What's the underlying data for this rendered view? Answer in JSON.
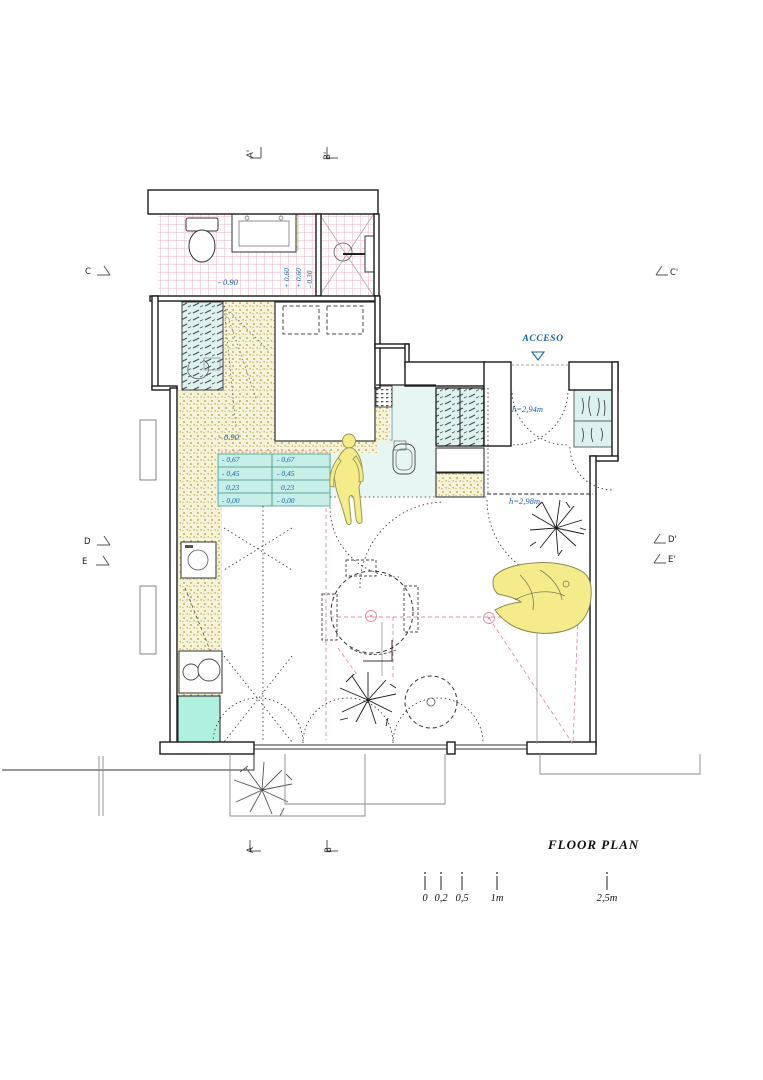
{
  "title": "FLOOR PLAN",
  "entry_label": "ACCESO",
  "heights": {
    "entry_hall": "h=2,94m",
    "living_room": "h=2,98m"
  },
  "bathroom": {
    "floor_level": "- 0.90",
    "shower_levels": [
      "+ 0.60",
      "+ 0.60",
      "- 0.30"
    ]
  },
  "steps": {
    "top": "- 0.90",
    "left": [
      "- 0,67",
      "- 0,45",
      "0,23",
      "- 0,00"
    ],
    "right": [
      "- 0,67",
      "- 0,45",
      "0,23",
      "- 0,00"
    ]
  },
  "sections": {
    "top": [
      "A'",
      "B'"
    ],
    "bottom": [
      "A",
      "B"
    ],
    "left": [
      "C",
      "D",
      "E"
    ],
    "right": [
      "C'",
      "D'",
      "E'"
    ]
  },
  "scale_bar": {
    "labels": [
      "0",
      "0,2",
      "0,5",
      "1m",
      "2,5m"
    ]
  },
  "colors": {
    "dimension_blue": "#1563ad",
    "tile_pink": "#efb6c5",
    "hatch_olive": "#a99e3b",
    "glass_teal": "#def1ed",
    "steps_teal": "#c7efe8",
    "highlight_yellow": "#f4ec8b",
    "construction_pink": "#e18ca0"
  }
}
